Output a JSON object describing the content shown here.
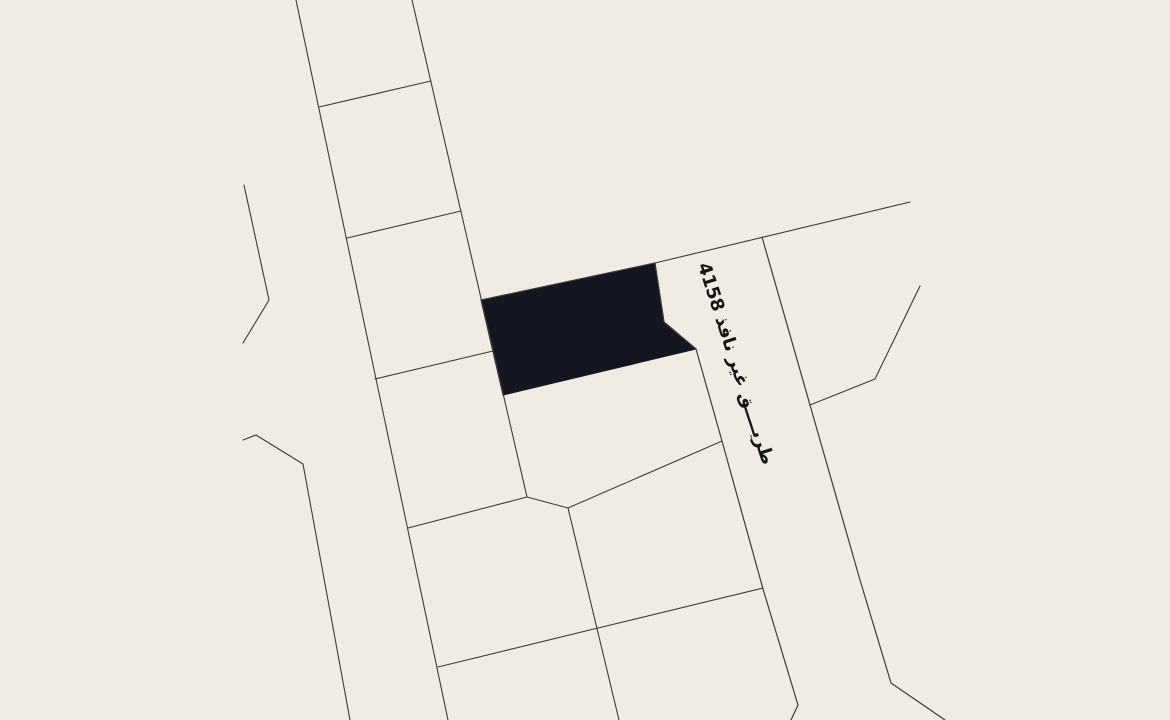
{
  "canvas": {
    "width": 1170,
    "height": 720,
    "background_color": "#f0ebe3",
    "line_color": "#3d3b38",
    "highlight_fill": "#131621",
    "label_color": "#151515"
  },
  "map": {
    "road_label": {
      "text": "طريق غير نافذ 4158",
      "display": "طريــــق غير نافذ 4158",
      "rotation_deg": 72,
      "x": 713,
      "y": 260,
      "font_size_px": 18
    },
    "highlighted_parcel": {
      "name": "selected-parcel",
      "points": [
        [
          481,
          300
        ],
        [
          655,
          263
        ],
        [
          664,
          322
        ],
        [
          696,
          349
        ],
        [
          503,
          395
        ]
      ]
    },
    "boundaries": [
      {
        "name": "block-left-boundary",
        "w": 1.1,
        "points": [
          [
            296,
            0
          ],
          [
            448,
            720
          ]
        ]
      },
      {
        "name": "block-right-boundary",
        "w": 1.1,
        "points": [
          [
            412,
            0
          ],
          [
            527,
            497
          ]
        ]
      },
      {
        "name": "parcel-divider-1",
        "w": 1.1,
        "points": [
          [
            319,
            107
          ],
          [
            431,
            81
          ]
        ]
      },
      {
        "name": "parcel-divider-2",
        "w": 1.1,
        "points": [
          [
            347,
            238
          ],
          [
            461,
            211
          ]
        ]
      },
      {
        "name": "parcel-divider-3",
        "w": 1.1,
        "points": [
          [
            375,
            379
          ],
          [
            493,
            351
          ]
        ]
      },
      {
        "name": "parcel-divider-4",
        "w": 1.1,
        "points": [
          [
            408,
            528
          ],
          [
            527,
            497
          ]
        ]
      },
      {
        "name": "west-boundary-upper",
        "w": 1.1,
        "points": [
          [
            244,
            185
          ],
          [
            269,
            300
          ],
          [
            243,
            343
          ]
        ]
      },
      {
        "name": "west-boundary-lower",
        "w": 1.1,
        "points": [
          [
            243,
            440
          ],
          [
            256,
            435
          ],
          [
            303,
            464
          ],
          [
            350,
            720
          ]
        ]
      },
      {
        "name": "north-diagonal-boundary",
        "w": 1.1,
        "points": [
          [
            481,
            300
          ],
          [
            655,
            263
          ],
          [
            910,
            202
          ]
        ]
      },
      {
        "name": "road-west-edge",
        "w": 1.2,
        "points": [
          [
            655,
            263
          ],
          [
            664,
            322
          ],
          [
            696,
            349
          ],
          [
            722,
            441
          ],
          [
            763,
            589
          ],
          [
            798,
            705
          ],
          [
            791,
            720
          ]
        ]
      },
      {
        "name": "road-east-edge",
        "w": 1.2,
        "points": [
          [
            762,
            237
          ],
          [
            810,
            405
          ],
          [
            860,
            580
          ],
          [
            891,
            683
          ],
          [
            945,
            720
          ]
        ]
      },
      {
        "name": "east-corner-boundary",
        "w": 1.1,
        "points": [
          [
            810,
            405
          ],
          [
            875,
            379
          ],
          [
            920,
            286
          ]
        ]
      },
      {
        "name": "south-long-divider",
        "w": 1.1,
        "points": [
          [
            438,
            667
          ],
          [
            598,
            628
          ],
          [
            763,
            588
          ]
        ]
      },
      {
        "name": "south-vertical-divider",
        "w": 1.1,
        "points": [
          [
            527,
            497
          ],
          [
            568,
            508
          ],
          [
            619,
            720
          ]
        ]
      },
      {
        "name": "south-diagonal-divider",
        "w": 1.1,
        "points": [
          [
            568,
            508
          ],
          [
            722,
            441
          ]
        ]
      }
    ]
  }
}
